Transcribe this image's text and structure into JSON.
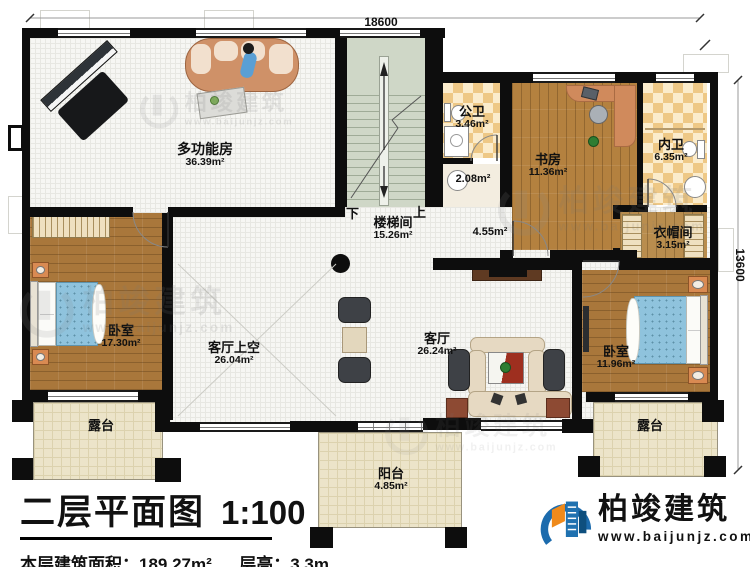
{
  "title_block": {
    "title": "二层平面图",
    "scale": "1:100",
    "area_label": "本层建筑面积：",
    "area_value": "189.27m²",
    "floor_height_label": "层高：",
    "floor_height_value": "3.3m"
  },
  "dimensions": {
    "top": "18600",
    "right": "13600"
  },
  "stairs": {
    "down_label": "下",
    "up_label": "上"
  },
  "rooms": {
    "multifunction": {
      "name": "多功能房",
      "area": "36.39m²"
    },
    "stair_hall": {
      "name": "楼梯间",
      "area": "15.26m²"
    },
    "corridor": {
      "name": "",
      "area": "4.55m²"
    },
    "public_bath": {
      "name": "公卫",
      "area": "3.46m²"
    },
    "bath_lobby": {
      "name": "",
      "area": "2.08m²"
    },
    "study": {
      "name": "书房",
      "area": "11.36m²"
    },
    "ensuite_bath": {
      "name": "内卫",
      "area": "6.35m²"
    },
    "cloakroom": {
      "name": "衣帽间",
      "area": "3.15m²"
    },
    "bedroom_left": {
      "name": "卧室",
      "area": "17.30m²"
    },
    "living_void": {
      "name": "客厅上空",
      "area": "26.04m²"
    },
    "living": {
      "name": "客厅",
      "area": "26.24m²"
    },
    "bedroom_right": {
      "name": "卧室",
      "area": "11.96m²"
    },
    "terrace_left": {
      "name": "露台",
      "area": ""
    },
    "terrace_right": {
      "name": "露台",
      "area": ""
    },
    "balcony": {
      "name": "阳台",
      "area": "4.85m²"
    }
  },
  "brand": {
    "name": "柏竣建筑",
    "website": "www.baijunjz.com"
  },
  "watermark": {
    "name": "柏竣建筑",
    "website": "www.baijunjz.com"
  },
  "colors": {
    "wall": "#0d0d0d",
    "wood": "#ad7a3c",
    "checker": "#eec886",
    "stair_floor": "#cfd7c7",
    "terrace_tile": "#ece4c9",
    "brand_blue": "#1c6bad",
    "brand_orange": "#ef8a1b"
  }
}
